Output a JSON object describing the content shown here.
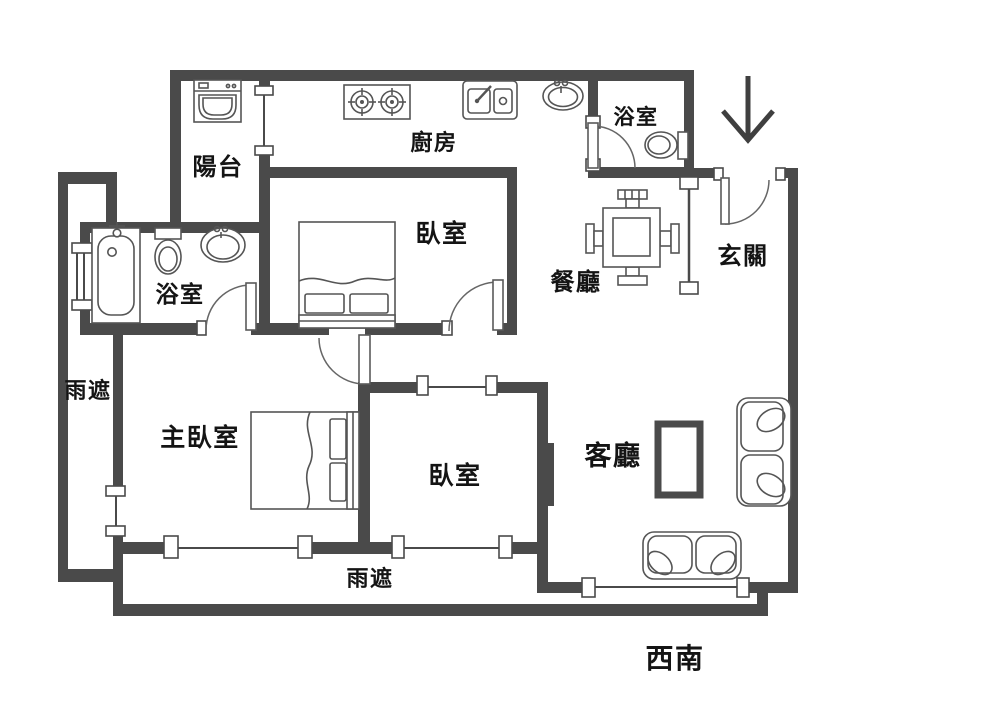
{
  "floorplan": {
    "rooms": {
      "balcony": "陽台",
      "kitchen": "廚房",
      "bedroom_upper": "臥室",
      "bathroom_main": "浴室",
      "bathroom_guest": "浴室",
      "dining": "餐廳",
      "foyer": "玄關",
      "master_bedroom": "主臥室",
      "bedroom_lower": "臥室",
      "living_room": "客廳",
      "rain_canopy_left": "雨遮",
      "rain_canopy_bottom": "雨遮"
    },
    "compass_label": "西南",
    "entrance_arrow_direction": "down",
    "fixtures": [
      "washing-machine",
      "gas-stove",
      "kitchen-sink",
      "wash-basin",
      "bathtub",
      "toilet",
      "vanity-sink",
      "toilet",
      "dining-table-with-four-chairs",
      "double-bed",
      "double-bed",
      "partition-screen",
      "tv",
      "tv-cabinet",
      "loveseat-sofa",
      "loveseat-sofa"
    ],
    "colors": {
      "wall": "#4a4a4a",
      "fixture_line": "#555555",
      "text": "#141414",
      "background": "#ffffff"
    }
  }
}
